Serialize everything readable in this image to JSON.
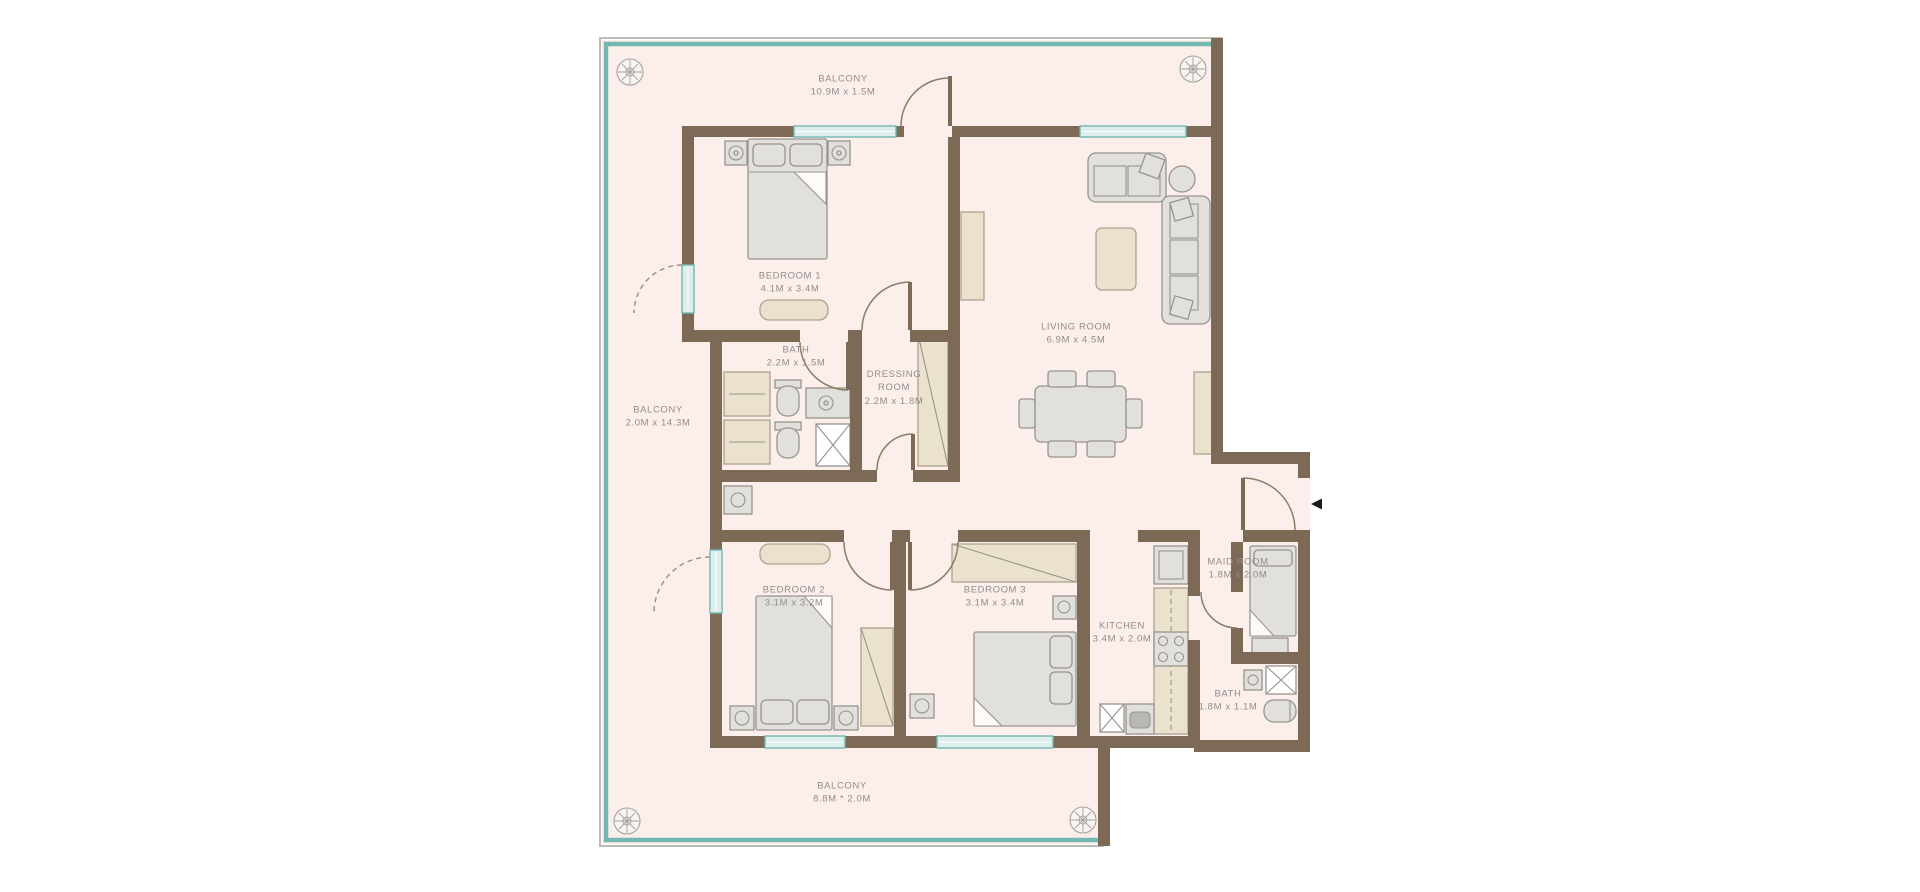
{
  "plan": {
    "type": "apartment-floor-plan",
    "colors": {
      "floor": "#fcefeb",
      "wall": "#7d6a56",
      "window_teal": "#72b8b0",
      "window_fill": "#ddeeec",
      "outer_line": "#bdbbb8",
      "furniture_gray": "#e2e0dc",
      "furniture_stroke": "#97948e",
      "furniture_beige": "#eae2cd",
      "label_text": "#8f8d8a",
      "arrow": "#1a1a1a"
    },
    "rooms": [
      {
        "name": "BALCONY",
        "dims": "10.9M x 1.5M"
      },
      {
        "name": "BEDROOM 1",
        "dims": "4.1M x 3.4M"
      },
      {
        "name": "LIVING ROOM",
        "dims": "6.9M x 4.5M"
      },
      {
        "name": "BATH",
        "dims": "2.2M x 1.5M"
      },
      {
        "name": "DRESSING ROOM",
        "dims": "2.2M x 1.8M"
      },
      {
        "name": "BALCONY",
        "dims": "2.0M x 14.3M"
      },
      {
        "name": "BEDROOM 2",
        "dims": "3.1M x 3.2M"
      },
      {
        "name": "BEDROOM 3",
        "dims": "3.1M x 3.4M"
      },
      {
        "name": "KITCHEN",
        "dims": "3.4M x 2.0M"
      },
      {
        "name": "MAID ROOM",
        "dims": "1.8M x 2.0M"
      },
      {
        "name": "BATH",
        "dims": "1.8M x 1.1M"
      },
      {
        "name": "BALCONY",
        "dims": "8.8M * 2.0M"
      }
    ],
    "icons": [
      {
        "name": "compass-rosette-icon",
        "count": 4
      },
      {
        "name": "entry-arrow-icon",
        "glyph": "left-pointing-triangle"
      }
    ]
  }
}
